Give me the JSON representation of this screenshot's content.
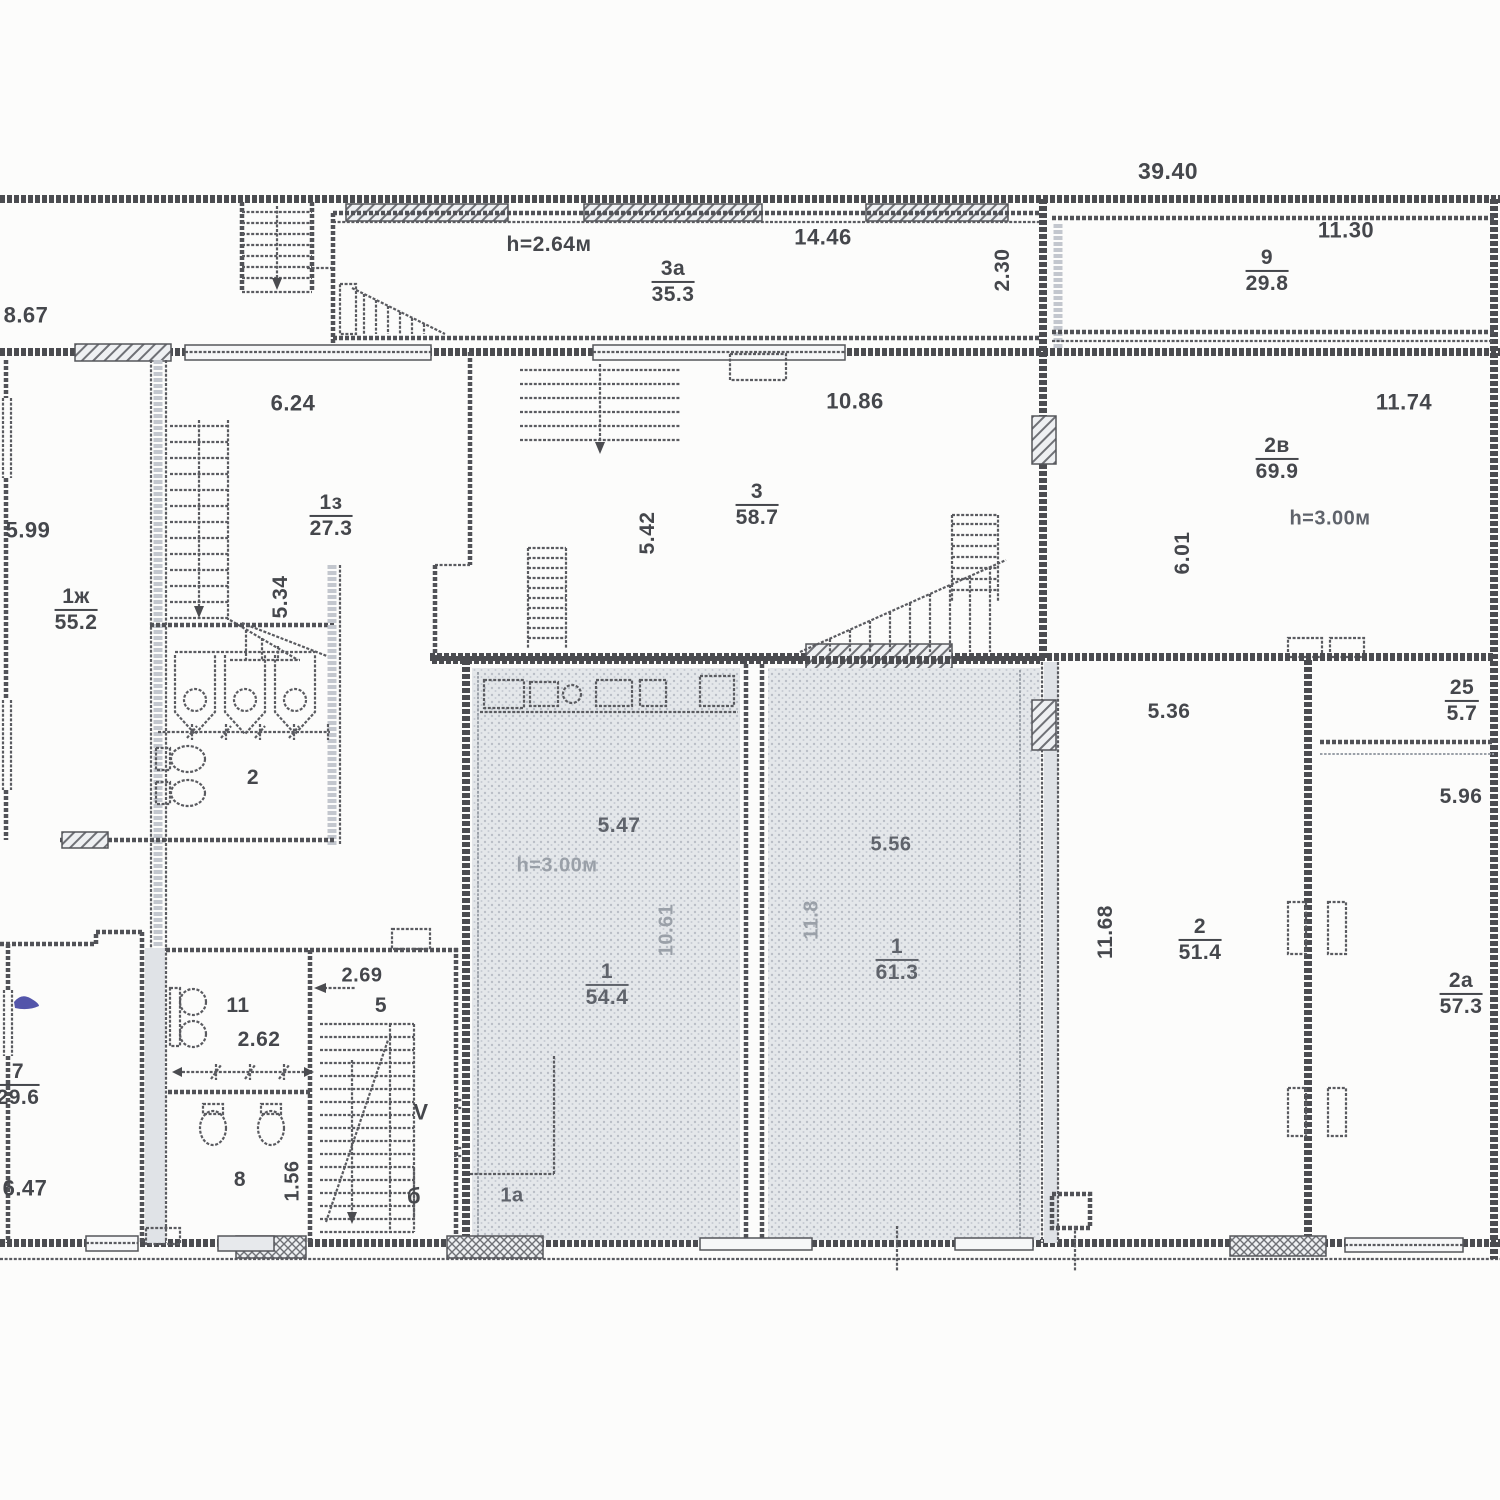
{
  "palette": {
    "ink": "#4b4c50",
    "faint_ink": "#9aa0a8",
    "shade_fill": "#e4e7ea",
    "shade_dot": "#b9bec6",
    "pen_mark": "#35379b",
    "paper": "#fcfcfb"
  },
  "plan": {
    "labels": [
      {
        "id": "dim-39-40",
        "kind": "plain",
        "text": "39.40",
        "x": 1168,
        "y": 171,
        "rot": 0,
        "tone": "dark",
        "size": 23
      },
      {
        "id": "dim-h-2-64",
        "kind": "plain",
        "text": "h=2.64м",
        "x": 549,
        "y": 245,
        "rot": 0,
        "tone": "dark",
        "size": 21
      },
      {
        "id": "room-3a",
        "kind": "frac",
        "num": "3а",
        "den": "35.3",
        "x": 673,
        "y": 282,
        "rot": 0,
        "tone": "dark",
        "size": 21
      },
      {
        "id": "dim-14-46",
        "kind": "plain",
        "text": "14.46",
        "x": 823,
        "y": 237,
        "rot": 0,
        "tone": "dark",
        "size": 22
      },
      {
        "id": "dim-2-30",
        "kind": "plain",
        "text": "2.30",
        "x": 1003,
        "y": 270,
        "rot": -90,
        "tone": "dark",
        "size": 21
      },
      {
        "id": "room-9",
        "kind": "frac",
        "num": "9",
        "den": "29.8",
        "x": 1267,
        "y": 271,
        "rot": 0,
        "tone": "dark",
        "size": 21
      },
      {
        "id": "dim-11-30",
        "kind": "plain",
        "text": "11.30",
        "x": 1346,
        "y": 230,
        "rot": 0,
        "tone": "dark",
        "size": 22
      },
      {
        "id": "dim-8-67",
        "kind": "plain",
        "text": "8.67",
        "x": 26,
        "y": 315,
        "rot": 0,
        "tone": "dark",
        "size": 22
      },
      {
        "id": "dim-6-24",
        "kind": "plain",
        "text": "6.24",
        "x": 293,
        "y": 403,
        "rot": 0,
        "tone": "dark",
        "size": 22
      },
      {
        "id": "dim-5-99",
        "kind": "plain",
        "text": "5.99",
        "x": 28,
        "y": 530,
        "rot": 0,
        "tone": "dark",
        "size": 22
      },
      {
        "id": "room-1zh",
        "kind": "frac",
        "num": "1ж",
        "den": "55.2",
        "x": 76,
        "y": 610,
        "rot": 0,
        "tone": "dark",
        "size": 21
      },
      {
        "id": "room-1z",
        "kind": "frac",
        "num": "1з",
        "den": "27.3",
        "x": 331,
        "y": 516,
        "rot": 0,
        "tone": "dark",
        "size": 21
      },
      {
        "id": "dim-5-34",
        "kind": "plain",
        "text": "5.34",
        "x": 281,
        "y": 597,
        "rot": -90,
        "tone": "dark",
        "size": 21
      },
      {
        "id": "dim-10-86",
        "kind": "plain",
        "text": "10.86",
        "x": 855,
        "y": 401,
        "rot": 0,
        "tone": "dark",
        "size": 22
      },
      {
        "id": "room-3",
        "kind": "frac",
        "num": "3",
        "den": "58.7",
        "x": 757,
        "y": 505,
        "rot": 0,
        "tone": "dark",
        "size": 21
      },
      {
        "id": "dim-5-42",
        "kind": "plain",
        "text": "5.42",
        "x": 648,
        "y": 533,
        "rot": -90,
        "tone": "dark",
        "size": 21
      },
      {
        "id": "dim-11-74",
        "kind": "plain",
        "text": "11.74",
        "x": 1404,
        "y": 402,
        "rot": 0,
        "tone": "dark",
        "size": 22
      },
      {
        "id": "room-2v",
        "kind": "frac",
        "num": "2в",
        "den": "69.9",
        "x": 1277,
        "y": 459,
        "rot": 0,
        "tone": "dark",
        "size": 21
      },
      {
        "id": "dim-h-3-00-2v",
        "kind": "plain",
        "text": "h=3.00м",
        "x": 1330,
        "y": 519,
        "rot": 0,
        "tone": "mid",
        "size": 20
      },
      {
        "id": "dim-6-01",
        "kind": "plain",
        "text": "6.01",
        "x": 1183,
        "y": 553,
        "rot": -90,
        "tone": "dark",
        "size": 21
      },
      {
        "id": "dim-5-36",
        "kind": "plain",
        "text": "5.36",
        "x": 1169,
        "y": 712,
        "rot": 0,
        "tone": "dark",
        "size": 21
      },
      {
        "id": "room-25",
        "kind": "frac",
        "num": "25",
        "den": "5.7",
        "x": 1462,
        "y": 701,
        "rot": 0,
        "tone": "dark",
        "size": 21
      },
      {
        "id": "dim-5-96",
        "kind": "plain",
        "text": "5.96",
        "x": 1461,
        "y": 797,
        "rot": 0,
        "tone": "dark",
        "size": 21
      },
      {
        "id": "dim-5-47",
        "kind": "plain",
        "text": "5.47",
        "x": 619,
        "y": 826,
        "rot": 0,
        "tone": "mid",
        "size": 21
      },
      {
        "id": "dim-h-3-00-1",
        "kind": "plain",
        "text": "h=3.00м",
        "x": 557,
        "y": 866,
        "rot": 0,
        "tone": "ghost",
        "size": 20
      },
      {
        "id": "room-1-left",
        "kind": "frac",
        "num": "1",
        "den": "54.4",
        "x": 607,
        "y": 985,
        "rot": 0,
        "tone": "mid",
        "size": 21
      },
      {
        "id": "dim-10-61",
        "kind": "plain",
        "text": "10.61",
        "x": 667,
        "y": 930,
        "rot": -90,
        "tone": "ghost",
        "size": 20
      },
      {
        "id": "dim-5-56",
        "kind": "plain",
        "text": "5.56",
        "x": 891,
        "y": 845,
        "rot": 0,
        "tone": "mid",
        "size": 20
      },
      {
        "id": "dim-11-8",
        "kind": "plain",
        "text": "11.8",
        "x": 812,
        "y": 920,
        "rot": -90,
        "tone": "ghost",
        "size": 20
      },
      {
        "id": "room-1-right",
        "kind": "frac",
        "num": "1",
        "den": "61.3",
        "x": 897,
        "y": 960,
        "rot": 0,
        "tone": "mid",
        "size": 21
      },
      {
        "id": "dim-11-68",
        "kind": "plain",
        "text": "11.68",
        "x": 1106,
        "y": 932,
        "rot": -90,
        "tone": "dark",
        "size": 21
      },
      {
        "id": "room-2",
        "kind": "frac",
        "num": "2",
        "den": "51.4",
        "x": 1200,
        "y": 940,
        "rot": 0,
        "tone": "dark",
        "size": 21
      },
      {
        "id": "room-2a",
        "kind": "frac",
        "num": "2а",
        "den": "57.3",
        "x": 1461,
        "y": 994,
        "rot": 0,
        "tone": "dark",
        "size": 21
      },
      {
        "id": "room-wc-2",
        "kind": "plain",
        "text": "2",
        "x": 253,
        "y": 778,
        "rot": 0,
        "tone": "dark",
        "size": 21
      },
      {
        "id": "room-11",
        "kind": "plain",
        "text": "11",
        "x": 238,
        "y": 1006,
        "rot": 0,
        "tone": "dark",
        "size": 21
      },
      {
        "id": "dim-2-62",
        "kind": "plain",
        "text": "2.62",
        "x": 259,
        "y": 1040,
        "rot": 0,
        "tone": "dark",
        "size": 21
      },
      {
        "id": "room-7",
        "kind": "frac",
        "num": "7",
        "den": "29.6",
        "x": 18,
        "y": 1085,
        "rot": 0,
        "tone": "dark",
        "size": 21
      },
      {
        "id": "dim-6-47",
        "kind": "plain",
        "text": "6.47",
        "x": 25,
        "y": 1188,
        "rot": 0,
        "tone": "dark",
        "size": 22
      },
      {
        "id": "room-8",
        "kind": "plain",
        "text": "8",
        "x": 240,
        "y": 1180,
        "rot": 0,
        "tone": "dark",
        "size": 21
      },
      {
        "id": "dim-1-56",
        "kind": "plain",
        "text": "1.56",
        "x": 293,
        "y": 1181,
        "rot": -90,
        "tone": "dark",
        "size": 20
      },
      {
        "id": "dim-2-69",
        "kind": "plain",
        "text": "2.69",
        "x": 362,
        "y": 976,
        "rot": 0,
        "tone": "dark",
        "size": 20
      },
      {
        "id": "stair-num-5",
        "kind": "plain",
        "text": "5",
        "x": 381,
        "y": 1006,
        "rot": 0,
        "tone": "dark",
        "size": 21
      },
      {
        "id": "stair-v",
        "kind": "plain",
        "text": "V",
        "x": 421,
        "y": 1112,
        "rot": 0,
        "tone": "dark",
        "size": 22
      },
      {
        "id": "stair-b",
        "kind": "plain",
        "text": "б",
        "x": 414,
        "y": 1196,
        "rot": 0,
        "tone": "dark",
        "size": 22
      },
      {
        "id": "room-1a",
        "kind": "plain",
        "text": "1а",
        "x": 512,
        "y": 1196,
        "rot": 0,
        "tone": "mid",
        "size": 20
      }
    ]
  }
}
